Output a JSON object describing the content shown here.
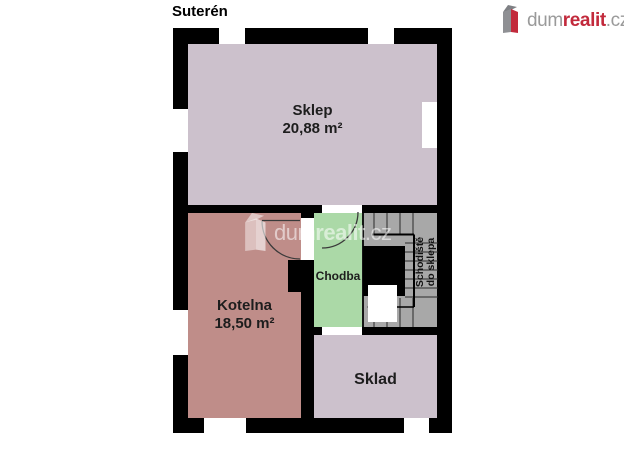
{
  "title": "Suterén",
  "logo": {
    "dum": "dum",
    "realit": "realit",
    "cz": ".cz",
    "gray": "#9a9a9a",
    "red": "#c22a3c"
  },
  "watermark": {
    "dum": "dum",
    "realit": "realit",
    "cz": ".cz"
  },
  "plan": {
    "wall_color": "#000000",
    "rooms": {
      "sklep": {
        "label": "Sklep",
        "area": "20,88 m²",
        "color": "#ccc1cc"
      },
      "kotelna": {
        "label": "Kotelna",
        "area": "18,50 m²",
        "color": "#bf8d89"
      },
      "chodba": {
        "label": "Chodba",
        "color": "#abd9a7"
      },
      "sklad": {
        "label": "Sklad",
        "color": "#ccc1cc"
      },
      "stairs": {
        "label_line1": "Schodiště",
        "label_line2": "do sklepa",
        "color": "#a8a8a8"
      }
    }
  }
}
